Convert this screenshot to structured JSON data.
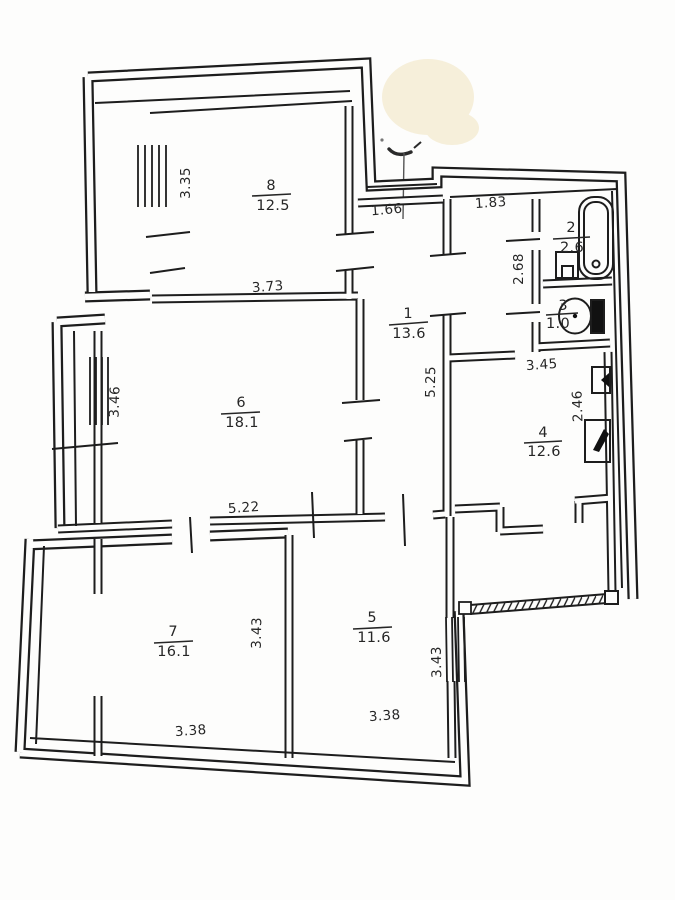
{
  "rooms": [
    {
      "number": "1",
      "area": "13.6"
    },
    {
      "number": "2",
      "area": "2.6"
    },
    {
      "number": "3",
      "area": "1.0"
    },
    {
      "number": "4",
      "area": "12.6"
    },
    {
      "number": "5",
      "area": "11.6"
    },
    {
      "number": "6",
      "area": "18.1"
    },
    {
      "number": "7",
      "area": "16.1"
    },
    {
      "number": "8",
      "area": "12.5"
    }
  ],
  "dimensions": [
    {
      "value": "3.35"
    },
    {
      "value": "3.73"
    },
    {
      "value": "1.66"
    },
    {
      "value": "1.83"
    },
    {
      "value": "5.25"
    },
    {
      "value": "2.68"
    },
    {
      "value": "3.45"
    },
    {
      "value": "2.46"
    },
    {
      "value": "3.46"
    },
    {
      "value": "5.22"
    },
    {
      "value": "3.43"
    },
    {
      "value": "3.38"
    },
    {
      "value": "3.43"
    },
    {
      "value": "3.38"
    }
  ],
  "colors": {
    "ink": "#1d1d1d",
    "paper": "#fdfdfc",
    "stain": "#f6efda"
  }
}
